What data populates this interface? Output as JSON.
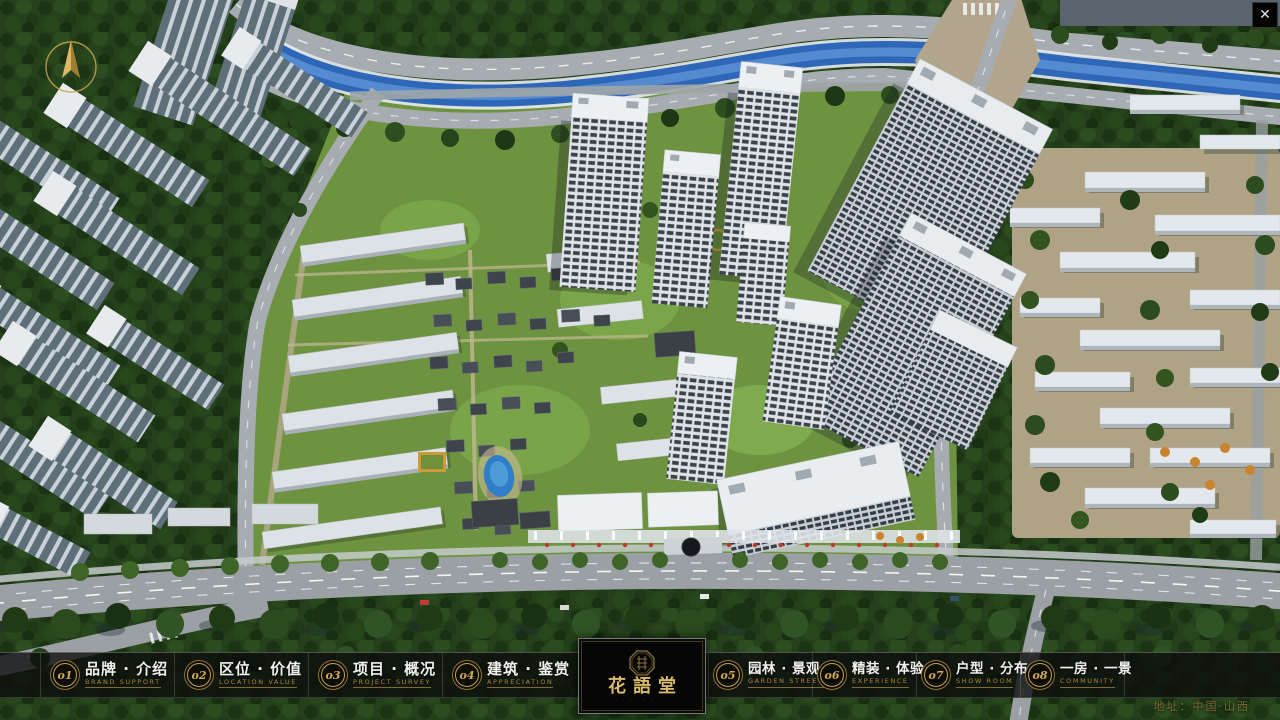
{
  "window": {
    "close_icon": "✕"
  },
  "compass": {
    "name": "north-compass"
  },
  "navbar": {
    "items": [
      {
        "num": "o1",
        "zh": "品牌 · 介绍",
        "en": "BRAND SUPPORT"
      },
      {
        "num": "o2",
        "zh": "区位 · 价值",
        "en": "LOCATION VALUE"
      },
      {
        "num": "o3",
        "zh": "项目 · 概况",
        "en": "PROJECT SURVEY"
      },
      {
        "num": "o4",
        "zh": "建筑 · 鉴赏",
        "en": "APPRECIATION"
      },
      {
        "num": "o5",
        "zh": "园林 · 景观",
        "en": "GARDEN STREET"
      },
      {
        "num": "o6",
        "zh": "精装 · 体验",
        "en": "EXPERIENCE"
      },
      {
        "num": "o7",
        "zh": "户型 · 分布",
        "en": "SHOW ROOM"
      },
      {
        "num": "o8",
        "zh": "一房 · 一景",
        "en": "COMMUNITY"
      }
    ]
  },
  "logo": {
    "title": "花語堂",
    "subtitle": "· · · · · · · ·"
  },
  "footer": {
    "address": "地址：中国·山西"
  },
  "colors": {
    "accent_gold": "#c9a44c",
    "caption_gold": "#a7873d",
    "bar_background": "rgba(12,12,12,0.78)",
    "river_blue": "#2e66b8",
    "lawn_green": "#6e9340",
    "tree_green": "#24411b",
    "road_gray": "#a7acb0",
    "building_white": "#e7ebee"
  }
}
